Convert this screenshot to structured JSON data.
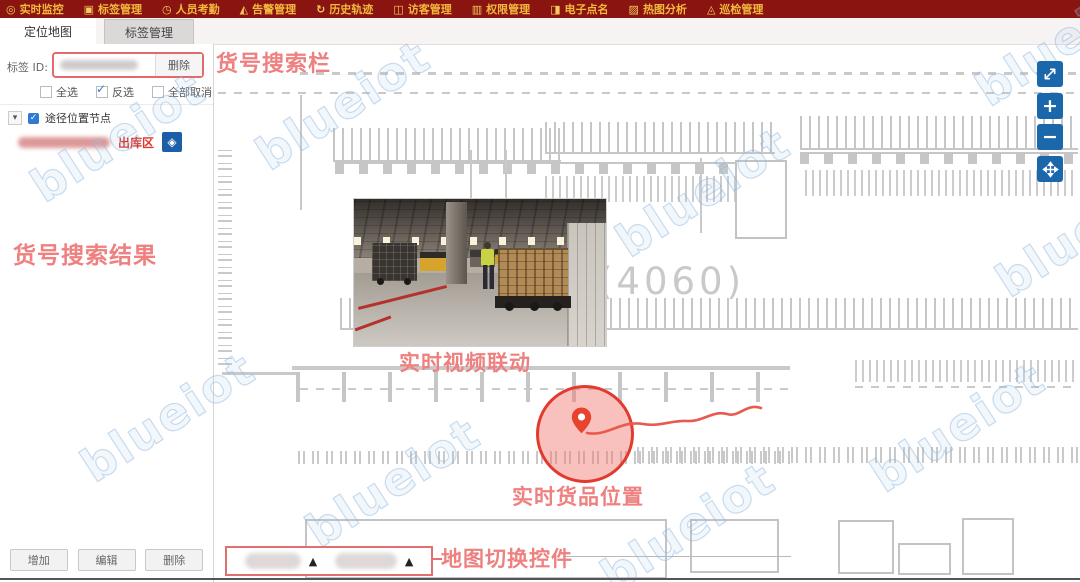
{
  "topbar": {
    "items": [
      {
        "label": "实时监控"
      },
      {
        "label": "标签管理"
      },
      {
        "label": "人员考勤"
      },
      {
        "label": "告警管理"
      },
      {
        "label": "历史轨迹"
      },
      {
        "label": "访客管理"
      },
      {
        "label": "权限管理"
      },
      {
        "label": "电子点名"
      },
      {
        "label": "热图分析"
      },
      {
        "label": "巡检管理"
      }
    ]
  },
  "sidebar": {
    "tabs": [
      {
        "label": "定位地图"
      },
      {
        "label": "标签管理"
      }
    ],
    "tag_id_label": "标签 ID:",
    "delete_button": "删除",
    "checkboxes": [
      {
        "label": "全选",
        "checked": false
      },
      {
        "label": "反选",
        "checked": true
      },
      {
        "label": "全部取消",
        "checked": false
      }
    ],
    "tree_node_label": "途径位置节点",
    "zone_label": "出库区",
    "buttons": {
      "add": "增加",
      "edit": "编辑",
      "delete": "删除"
    }
  },
  "annotations": {
    "search_bar": "货号搜索栏",
    "search_results": "货号搜索结果",
    "video_link": "实时视频联动",
    "cargo_position": "实时货品位置",
    "map_switcher": "地图切换控件"
  },
  "map": {
    "area_label": "(4060)",
    "watermark": "blueiot",
    "dropdown_arrow": "▲",
    "zoom_in": "+",
    "zoom_out": "−",
    "locate_icon": "◈"
  },
  "colors": {
    "topbar_bg": "#8a1410",
    "topbar_text": "#f2b93e",
    "annotation_red": "#ee8080",
    "accent_blue": "#1a67ab",
    "highlight_red": "#e23b2e"
  }
}
